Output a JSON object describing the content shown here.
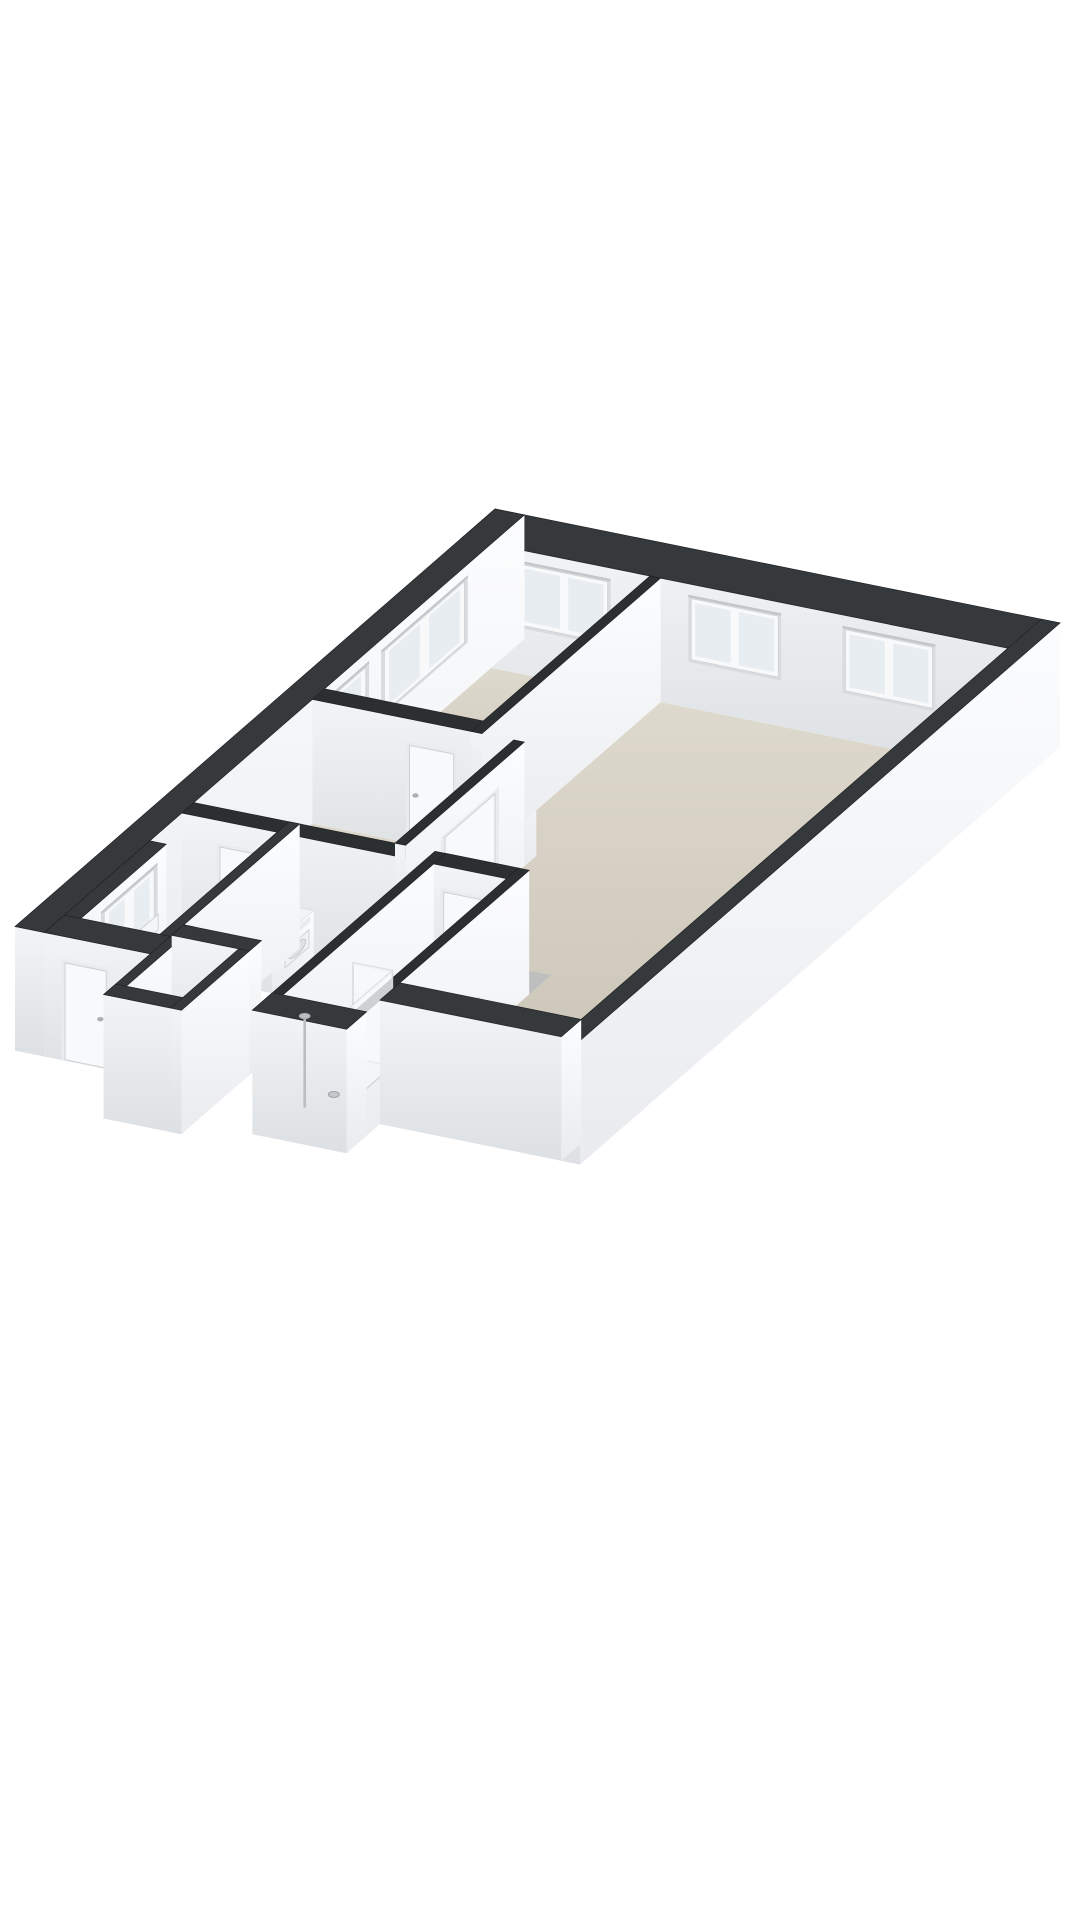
{
  "scene": {
    "title": "3d-floorplan-isometric-render",
    "background": "#ffffff"
  },
  "floorplan_model": {
    "projection": {
      "origin": [
        495,
        633
      ],
      "axis_a": [
        58.854,
        11.875
      ],
      "axis_b": [
        -66.667,
        58.0
      ],
      "z_px_per_m": 47.7,
      "wall_height": 2.6
    },
    "colors": {
      "background": "#ffffff",
      "wall_top_exterior": "#36393c",
      "wall_top_interior": "#2c2f31",
      "wall_top_stroke": "#202325",
      "face_a_light": "#fcfdfe",
      "face_a_dark": "#e9ebee",
      "face_b_light": "#f2f4f5",
      "face_b_dark": "#dde0e3",
      "floor_light": "#ded9cd",
      "floor_dark": "#c8c2b4",
      "floor_shadow": "#b7bbbf",
      "window_reveal": "#d9dcdf",
      "window_frame": "#f7f9fa",
      "window_frame_stroke": "#cfd3d6",
      "window_glass": "#e8edf1",
      "window_top_shadow": "#c2c6c9",
      "door_frame": "#e9ebed",
      "door_leaf": "#f8f9fa",
      "door_leaf_stroke": "#ced2d5",
      "door_handle": "#a9afb4",
      "appliance_top": "#f2f3f4",
      "appliance_panel": "#e9ebed",
      "drum_outer": "#e3e5e7",
      "drum_outer_stroke": "#c3c7ca",
      "drum_inner": "#9aa0a5",
      "glass_fill": "rgba(248,250,251,0.55)",
      "glass_stroke": "#d3d7da",
      "glass_top": "#eef0f2",
      "chrome": "#b9bec2",
      "chrome_dark": "#9da2a7",
      "fixture_fill": "#f3f5f6",
      "fixture_stroke": "#d0d4d7"
    },
    "floors": [
      {
        "id": "floor-bedroom",
        "pts": [
          [
            0.5,
            0.5
          ],
          [
            3.2,
            0.5
          ],
          [
            3.2,
            3.0
          ],
          [
            0.5,
            3.0
          ]
        ]
      },
      {
        "id": "floor-living-room",
        "pts": [
          [
            3.38,
            0.5
          ],
          [
            9.28,
            0.5
          ],
          [
            9.28,
            6.9
          ],
          [
            6.2,
            6.9
          ],
          [
            6.2,
            4.96
          ],
          [
            4.1,
            4.96
          ],
          [
            4.1,
            3.0
          ],
          [
            3.38,
            3.0
          ]
        ]
      },
      {
        "id": "floor-hallway",
        "pts": [
          [
            0.5,
            3.18
          ],
          [
            3.92,
            3.18
          ],
          [
            3.92,
            4.96
          ],
          [
            0.5,
            4.96
          ]
        ]
      },
      {
        "id": "floor-laundry",
        "pts": [
          [
            0.5,
            5.14
          ],
          [
            2.12,
            5.14
          ],
          [
            2.12,
            6.9
          ],
          [
            0.78,
            6.9
          ],
          [
            0.78,
            5.62
          ],
          [
            0.5,
            5.62
          ]
        ]
      },
      {
        "id": "floor-bathroom",
        "pts": [
          [
            4.78,
            5.14
          ],
          [
            6.02,
            5.14
          ],
          [
            6.02,
            7.4
          ],
          [
            4.78,
            7.4
          ]
        ]
      },
      {
        "id": "floor-storage",
        "pts": [
          [
            2.48,
            6.88
          ],
          [
            3.44,
            6.88
          ],
          [
            3.44,
            7.72
          ],
          [
            2.48,
            7.72
          ]
        ]
      }
    ],
    "floor_shades": [
      {
        "id": "shade-bedroom-s",
        "pts": [
          [
            0.5,
            2.7
          ],
          [
            3.2,
            2.7
          ],
          [
            3.2,
            3.0
          ],
          [
            0.5,
            3.0
          ]
        ]
      },
      {
        "id": "shade-bedroom-e",
        "pts": [
          [
            2.9,
            0.5
          ],
          [
            3.2,
            0.5
          ],
          [
            3.2,
            2.7
          ],
          [
            2.9,
            2.7
          ]
        ]
      },
      {
        "id": "shade-living-s",
        "pts": [
          [
            6.2,
            6.57
          ],
          [
            9.28,
            6.57
          ],
          [
            9.28,
            6.9
          ],
          [
            6.2,
            6.9
          ]
        ]
      },
      {
        "id": "shade-living-e",
        "pts": [
          [
            8.95,
            0.5
          ],
          [
            9.28,
            0.5
          ],
          [
            9.28,
            6.57
          ],
          [
            8.95,
            6.57
          ]
        ]
      },
      {
        "id": "shade-living-bath",
        "pts": [
          [
            4.1,
            4.63
          ],
          [
            6.2,
            4.63
          ],
          [
            6.2,
            4.96
          ],
          [
            4.1,
            4.96
          ]
        ]
      },
      {
        "id": "shade-hall-s",
        "pts": [
          [
            0.5,
            4.63
          ],
          [
            3.92,
            4.63
          ],
          [
            3.92,
            4.96
          ],
          [
            0.5,
            4.96
          ]
        ]
      },
      {
        "id": "shade-hall-e",
        "pts": [
          [
            3.59,
            3.18
          ],
          [
            3.92,
            3.18
          ],
          [
            3.92,
            4.63
          ],
          [
            3.59,
            4.63
          ]
        ]
      },
      {
        "id": "shade-laundry-s",
        "pts": [
          [
            0.78,
            6.57
          ],
          [
            2.12,
            6.57
          ],
          [
            2.12,
            6.9
          ],
          [
            0.78,
            6.9
          ]
        ]
      },
      {
        "id": "shade-laundry-e",
        "pts": [
          [
            1.79,
            5.14
          ],
          [
            2.12,
            5.14
          ],
          [
            2.12,
            6.57
          ],
          [
            1.79,
            6.57
          ]
        ]
      },
      {
        "id": "shade-bathroom-s",
        "pts": [
          [
            4.78,
            7.07
          ],
          [
            6.02,
            7.07
          ],
          [
            6.02,
            7.4
          ],
          [
            4.78,
            7.4
          ]
        ]
      },
      {
        "id": "shade-bathroom-e",
        "pts": [
          [
            5.69,
            5.14
          ],
          [
            6.02,
            5.14
          ],
          [
            6.02,
            7.07
          ],
          [
            5.69,
            7.07
          ]
        ]
      },
      {
        "id": "shade-storage-s",
        "pts": [
          [
            2.48,
            7.39
          ],
          [
            3.44,
            7.39
          ],
          [
            3.44,
            7.72
          ],
          [
            2.48,
            7.72
          ]
        ]
      },
      {
        "id": "shade-storage-e",
        "pts": [
          [
            3.11,
            6.88
          ],
          [
            3.44,
            6.88
          ],
          [
            3.44,
            7.39
          ],
          [
            3.11,
            7.39
          ]
        ]
      }
    ],
    "walls": [
      {
        "id": "wall-ne-facade",
        "kind": "exterior",
        "a1": 0.0,
        "b1": 0.0,
        "a2": 9.6,
        "b2": 0.5
      },
      {
        "id": "wall-nw-facade",
        "kind": "exterior",
        "a1": 0.0,
        "b1": 0.0,
        "a2": 0.5,
        "b2": 7.2
      },
      {
        "id": "wall-nw-step",
        "kind": "exterior",
        "a1": 0.5,
        "b1": 5.62,
        "a2": 0.78,
        "b2": 7.2
      },
      {
        "id": "wall-se-facade",
        "kind": "exterior",
        "a1": 9.28,
        "b1": 0.0,
        "a2": 9.6,
        "b2": 7.2
      },
      {
        "id": "wall-sw-laundry",
        "kind": "exterior",
        "a1": 0.5,
        "b1": 6.9,
        "a2": 2.3,
        "b2": 7.2
      },
      {
        "id": "wall-laundry-se",
        "kind": "exterior",
        "a1": 2.12,
        "b1": 4.96,
        "a2": 2.3,
        "b2": 6.9
      },
      {
        "id": "wall-sw-living",
        "kind": "exterior",
        "a1": 6.2,
        "b1": 6.9,
        "a2": 9.28,
        "b2": 7.2
      },
      {
        "id": "wall-bedroom-living",
        "kind": "interior",
        "a1": 3.2,
        "b1": 0.5,
        "a2": 3.38,
        "b2": 3.18
      },
      {
        "id": "wall-bedroom-hall",
        "kind": "interior",
        "a1": 0.5,
        "b1": 3.0,
        "a2": 4.1,
        "b2": 3.18
      },
      {
        "id": "wall-hall-living",
        "kind": "interior",
        "a1": 3.92,
        "b1": 3.18,
        "a2": 4.1,
        "b2": 4.96
      },
      {
        "id": "wall-hall-south",
        "kind": "interior",
        "a1": 0.5,
        "b1": 4.96,
        "a2": 4.6,
        "b2": 5.14
      },
      {
        "id": "wall-bathroom-nw",
        "kind": "interior",
        "a1": 4.6,
        "b1": 4.96,
        "a2": 4.78,
        "b2": 7.7
      },
      {
        "id": "wall-bathroom-ne",
        "kind": "interior",
        "a1": 4.78,
        "b1": 4.96,
        "a2": 6.02,
        "b2": 5.14
      },
      {
        "id": "wall-bathroom-se",
        "kind": "interior",
        "a1": 6.02,
        "b1": 4.96,
        "a2": 6.2,
        "b2": 7.7
      },
      {
        "id": "wall-bathroom-sw",
        "kind": "exterior",
        "a1": 4.6,
        "b1": 7.4,
        "a2": 6.2,
        "b2": 7.7
      },
      {
        "id": "wall-storage-nw",
        "kind": "exterior",
        "a1": 2.3,
        "b1": 6.7,
        "a2": 2.48,
        "b2": 7.9
      },
      {
        "id": "wall-storage-ne",
        "kind": "exterior",
        "a1": 2.3,
        "b1": 6.7,
        "a2": 3.62,
        "b2": 6.88
      },
      {
        "id": "wall-storage-se",
        "kind": "exterior",
        "a1": 3.44,
        "b1": 6.88,
        "a2": 3.62,
        "b2": 7.9
      },
      {
        "id": "wall-storage-sw",
        "kind": "exterior",
        "a1": 2.3,
        "b1": 7.72,
        "a2": 3.62,
        "b2": 7.9
      }
    ],
    "windows": [
      {
        "id": "window-bedroom-ne",
        "wall": "wall-ne-facade",
        "face": "b",
        "t1": 1.0,
        "t2": 2.48,
        "z1": 1.02,
        "z2": 2.3,
        "panes": 2
      },
      {
        "id": "window-living-ne-1",
        "wall": "wall-ne-facade",
        "face": "b",
        "t1": 3.9,
        "t2": 5.38,
        "z1": 1.02,
        "z2": 2.3,
        "panes": 2
      },
      {
        "id": "window-living-ne-2",
        "wall": "wall-ne-facade",
        "face": "b",
        "t1": 6.52,
        "t2": 8.0,
        "z1": 1.02,
        "z2": 2.3,
        "panes": 2
      },
      {
        "id": "window-bedroom-nw-1",
        "wall": "wall-nw-facade",
        "face": "a",
        "t1": 0.9,
        "t2": 2.1,
        "z1": 1.02,
        "z2": 2.3,
        "panes": 2
      },
      {
        "id": "window-bedroom-nw-2",
        "wall": "wall-nw-facade",
        "face": "a",
        "t1": 2.38,
        "t2": 2.95,
        "z1": 1.02,
        "z2": 2.3,
        "panes": 1
      },
      {
        "id": "window-laundry-nw",
        "wall": "wall-nw-step",
        "face": "a",
        "t1": 5.8,
        "t2": 6.55,
        "z1": 1.02,
        "z2": 2.3,
        "panes": 2
      }
    ],
    "doors": [
      {
        "id": "door-bedroom",
        "wall": "wall-bedroom-hall",
        "face": "b",
        "t1": 2.15,
        "t2": 2.9,
        "handle": "t1"
      },
      {
        "id": "door-living",
        "wall": "wall-hall-living",
        "face": "a",
        "t1": 3.62,
        "t2": 4.37,
        "handle": "t2"
      },
      {
        "id": "door-laundry",
        "wall": "wall-hall-south",
        "face": "b",
        "t1": 1.15,
        "t2": 1.9,
        "handle": "t2"
      },
      {
        "id": "door-bathroom",
        "wall": "wall-bathroom-ne",
        "face": "b",
        "t1": 4.95,
        "t2": 5.7,
        "handle": "t1"
      },
      {
        "id": "door-entrance",
        "wall": "wall-sw-laundry",
        "face": "b",
        "t1": 0.85,
        "t2": 1.55,
        "handle": "t2"
      }
    ],
    "wall_decor": [
      {
        "id": "radiator-living",
        "wall": "wall-bathroom-se",
        "face": "a",
        "t1": 5.72,
        "t2": 6.3,
        "z1": 0.34,
        "z2": 0.86
      },
      {
        "id": "meter-cabinet-laundry",
        "wall": "wall-nw-step",
        "face": "a",
        "t1": 5.74,
        "t2": 6.02,
        "z1": 0.95,
        "z2": 1.28
      }
    ],
    "fixtures": [
      {
        "id": "washing-machine",
        "type": "washer",
        "a1": 1.3,
        "b1": 5.2,
        "a2": 1.98,
        "b2": 5.9,
        "h": 0.86,
        "drum": {
          "c": 1.64,
          "cz": 0.44,
          "r": 0.25,
          "r2": 0.16
        },
        "panel": {
          "t1": 1.36,
          "t2": 1.92,
          "z1": 0.68,
          "z2": 0.82
        }
      },
      {
        "id": "dryer",
        "type": "dryer",
        "a1": 2.0,
        "b1": 5.05,
        "a2": 2.64,
        "b2": 5.67,
        "h": 0.98,
        "door": {
          "t1": 5.12,
          "t2": 5.48,
          "z1": 0.3,
          "z2": 0.66,
          "r": 0.13
        },
        "panel": {
          "t1": 5.1,
          "t2": 5.6,
          "z1": 0.8,
          "z2": 0.93
        }
      },
      {
        "id": "shower-glass-return",
        "type": "glass-b",
        "b": 6.35,
        "t1": 4.78,
        "t2": 5.45,
        "h": 2.0
      },
      {
        "id": "shower-glass-side",
        "type": "glass-a",
        "a": 5.45,
        "t1": 6.35,
        "t2": 7.4,
        "h": 2.0
      },
      {
        "id": "shower-column",
        "type": "column",
        "a": 4.9,
        "b": 7.18,
        "h": 1.92
      },
      {
        "id": "shower-drain",
        "type": "drain",
        "a": 5.1,
        "b": 6.92
      }
    ]
  }
}
